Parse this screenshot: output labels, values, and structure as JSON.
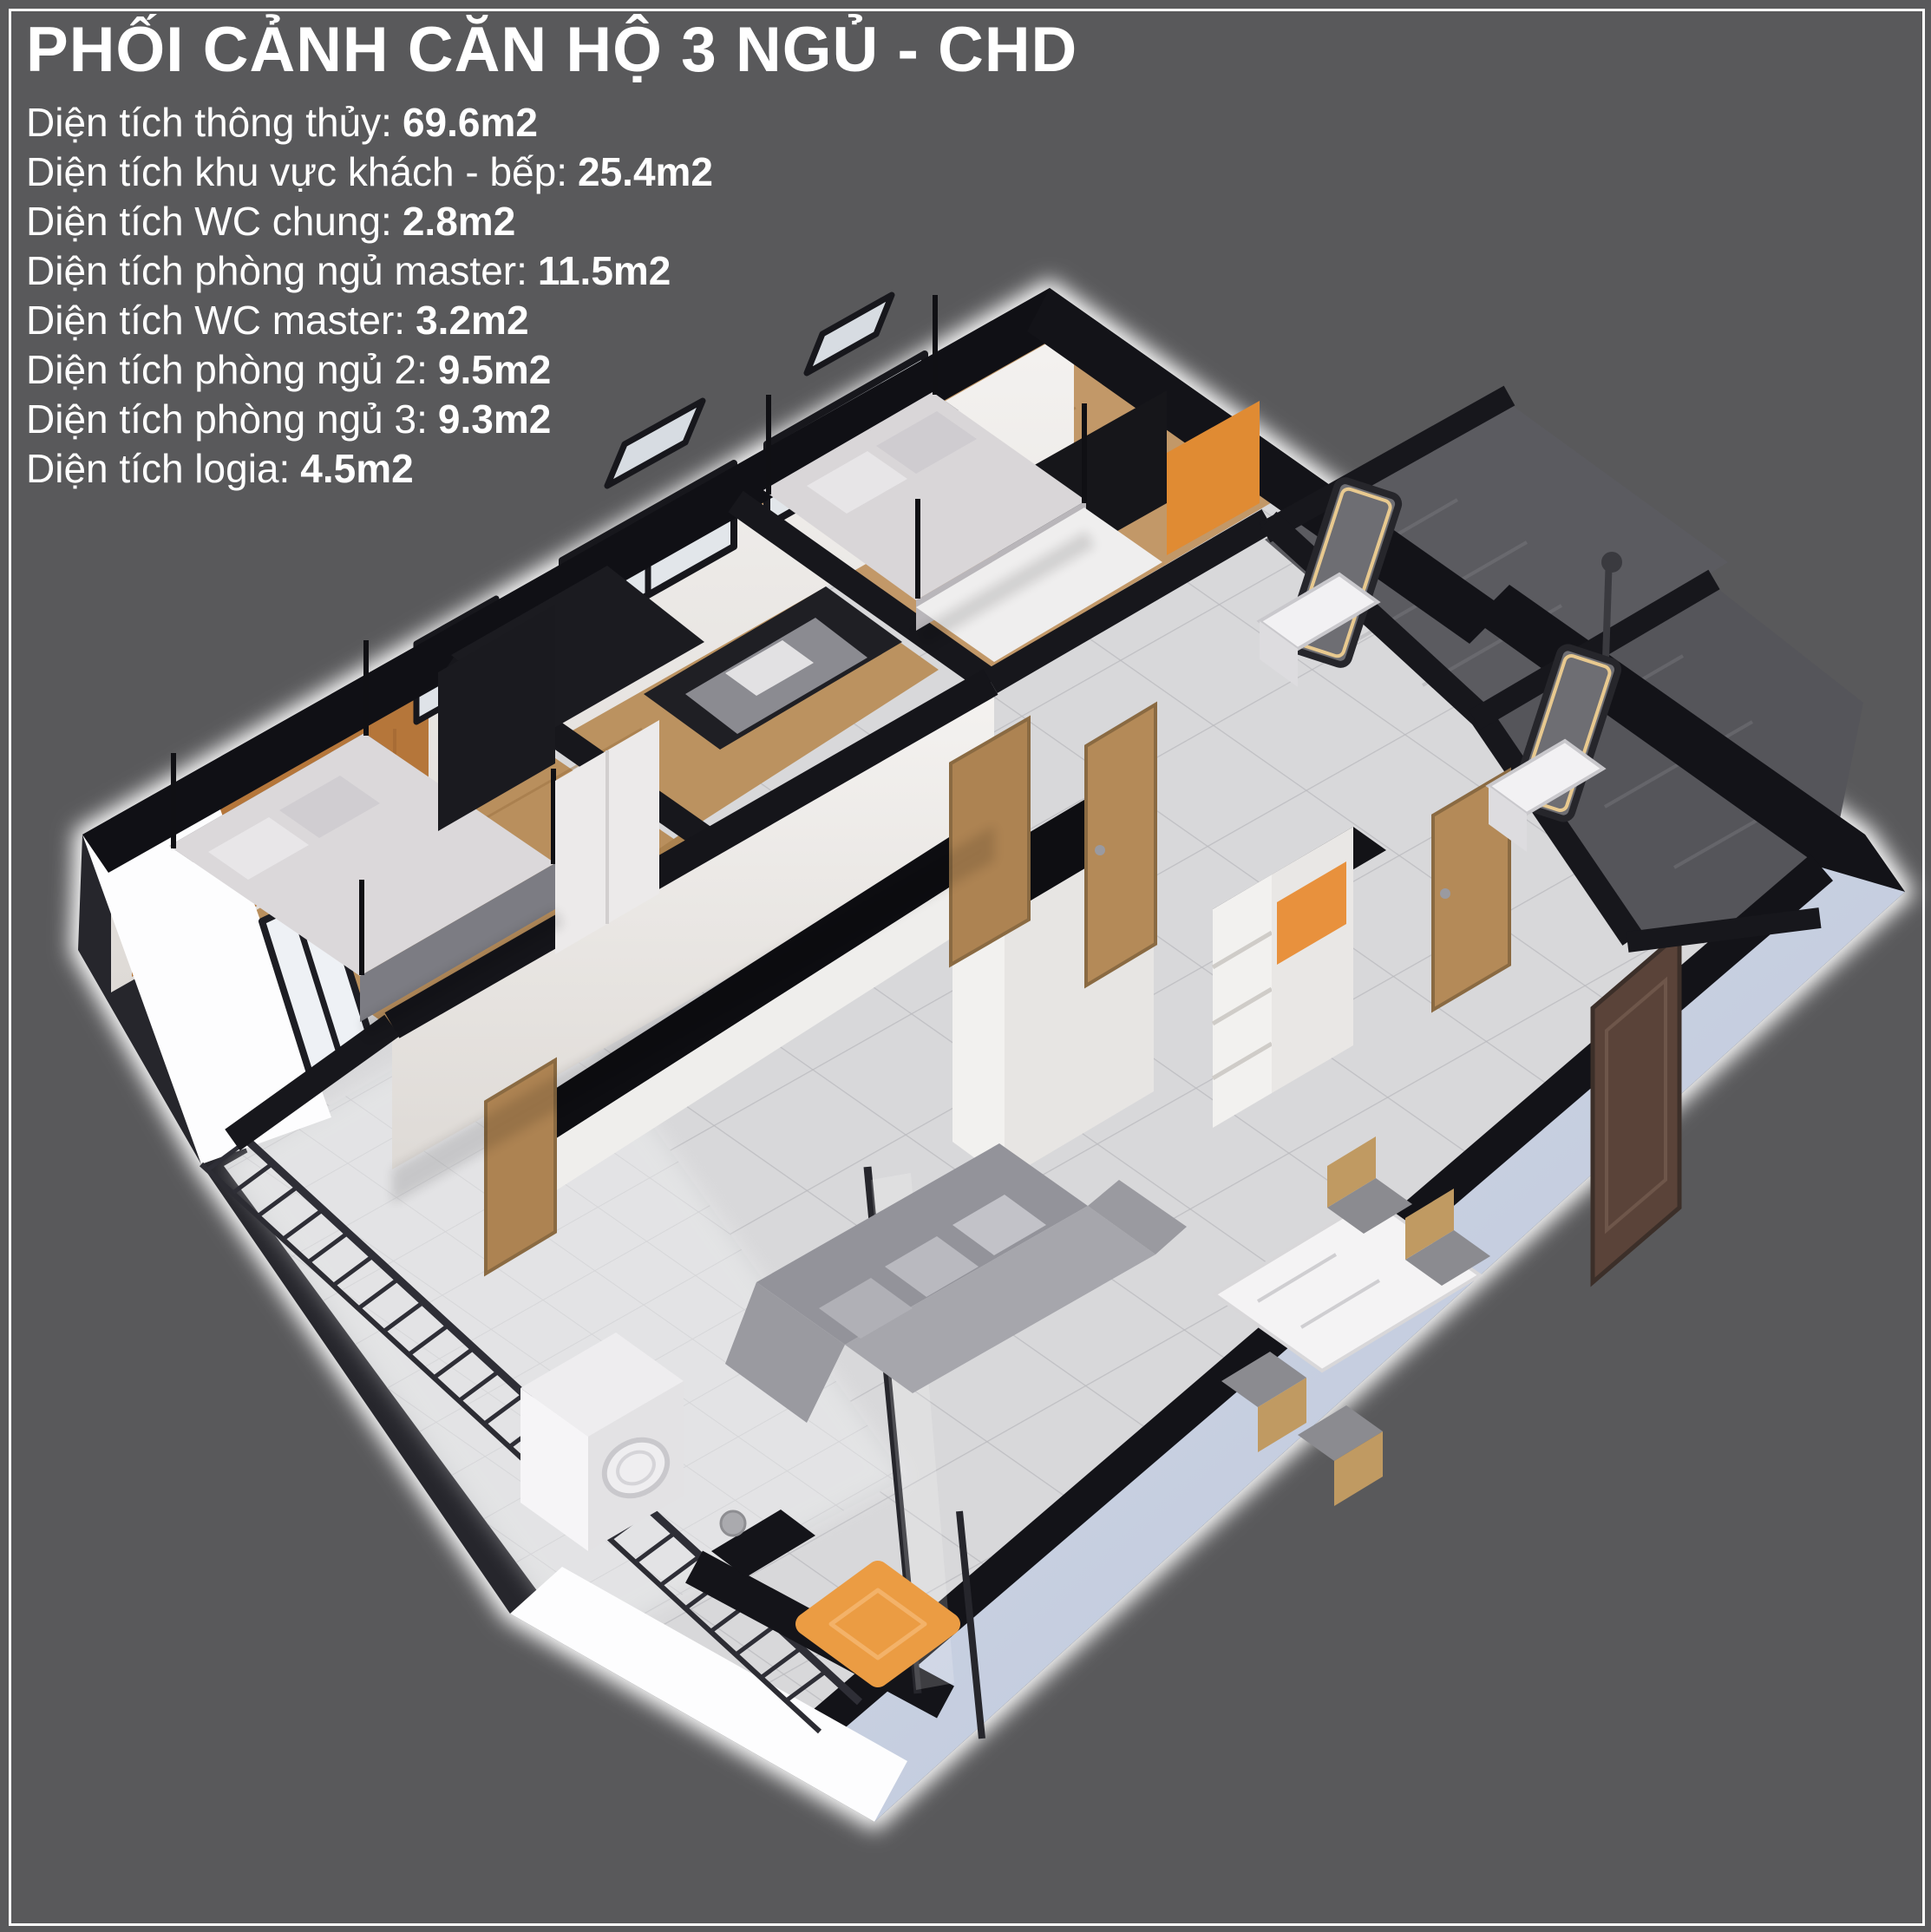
{
  "header": {
    "title": "PHỐI CẢNH CĂN HỘ 3 NGỦ - CHD"
  },
  "specs": [
    {
      "label": "Diện tích thông thủy:",
      "value": "69.6m2"
    },
    {
      "label": "Diện tích khu vực khách - bếp:",
      "value": "25.4m2"
    },
    {
      "label": "Diện tích WC chung:",
      "value": "2.8m2"
    },
    {
      "label": "Diện tích phòng ngủ master:",
      "value": "11.5m2"
    },
    {
      "label": "Diện tích WC master:",
      "value": "3.2m2"
    },
    {
      "label": "Diện tích phòng ngủ 2:",
      "value": "9.5m2"
    },
    {
      "label": "Diện tích phòng ngủ 3:",
      "value": "9.3m2"
    },
    {
      "label": "Diện tích logia:",
      "value": "4.5m2"
    }
  ],
  "floorplan": {
    "view_type": "3d-axonometric-cutaway-render",
    "rooms_depicted": [
      "khu vực khách - bếp",
      "WC chung",
      "phòng ngủ master",
      "WC master",
      "phòng ngủ 2",
      "phòng ngủ 3",
      "logia"
    ],
    "palette": {
      "background": "#59595b",
      "frame_border": "#ffffff",
      "text": "#ffffff",
      "wall_top_black": "#131318",
      "wall_face_white": "#f2f0ee",
      "exterior_blue_wall": "#c8d1e2",
      "tile_floor": "#d8d8da",
      "wood_floor": "#bb9260",
      "wood_panel_orange": "#b5763a",
      "accent_orange": "#e8953f",
      "bathroom_tile_dark": "#595960",
      "sofa_gray": "#9a9aa0",
      "bed_linen": "#d9d6d8",
      "door_wood": "#b48a58",
      "railing_black": "#2e2e36"
    }
  }
}
